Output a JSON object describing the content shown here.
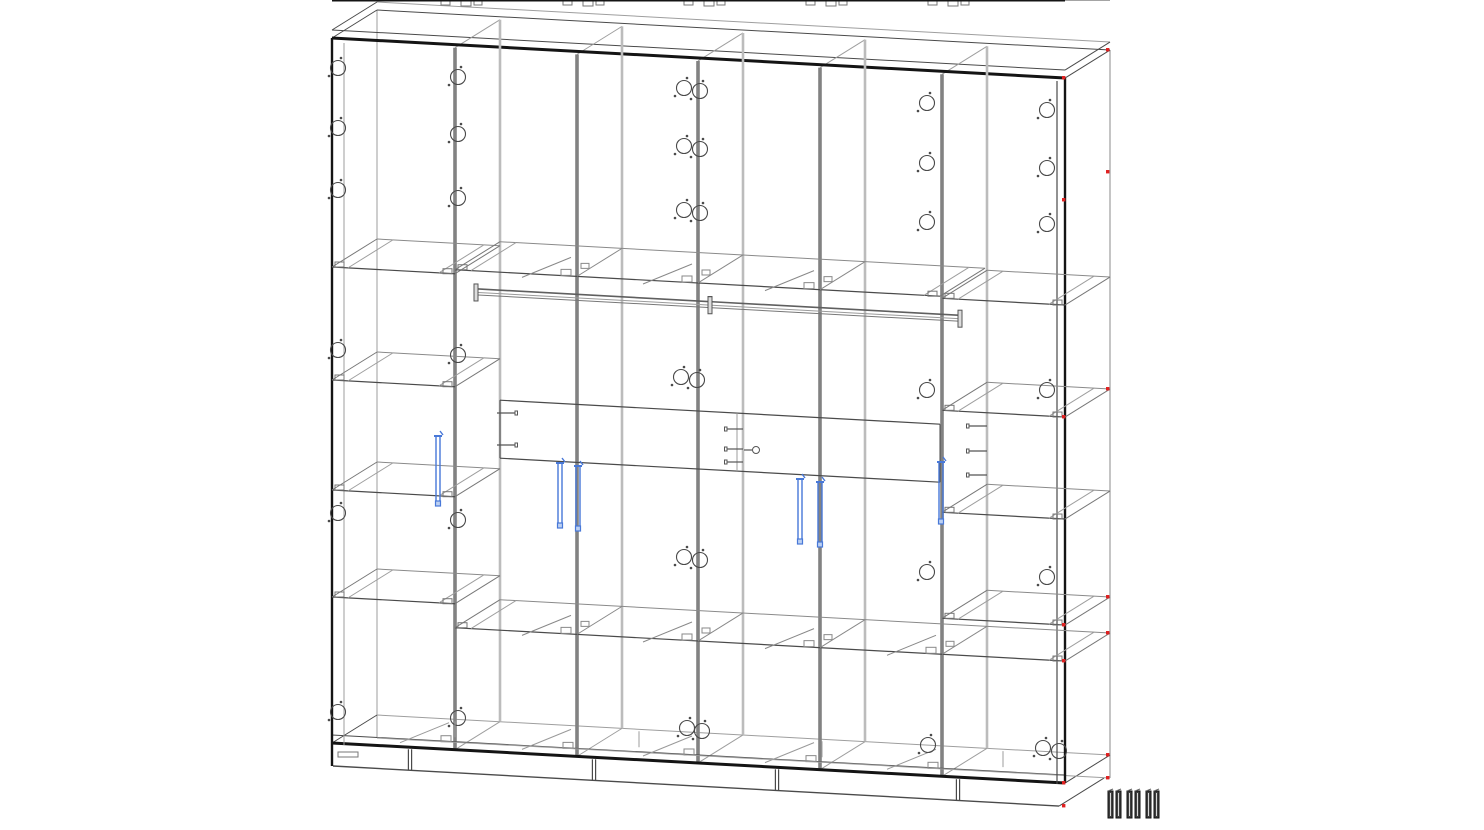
{
  "canvas": {
    "width": 1484,
    "height": 830,
    "background": "#ffffff"
  },
  "colors": {
    "outline": "#141414",
    "line": "#4a4a4a",
    "light": "#9e9e9e",
    "panel": "#828282",
    "panel_back": "#bcbcbc",
    "hardware": "#6f6f6f",
    "blue": "#4878d8",
    "red": "#e02020",
    "strip_fill": "#3f3f3f",
    "strip_inner": "#d8d8d8"
  },
  "view": {
    "x_left": 332,
    "x_right": 1065,
    "top_y": 38,
    "shear": 0.0546,
    "body_h": 705,
    "plinth_h": 23,
    "depth_dx": 45,
    "depth_dy": -28
  },
  "partitions": [
    455,
    577,
    698,
    820,
    942
  ],
  "mezzanine_h": 122,
  "shelves": [
    {
      "x1": 332,
      "x2": 455,
      "h": 229
    },
    {
      "x1": 332,
      "x2": 455,
      "h": 342
    },
    {
      "x1": 332,
      "x2": 455,
      "h": 452
    },
    {
      "x1": 332,
      "x2": 455,
      "h": 559
    },
    {
      "x1": 942,
      "x2": 1065,
      "h": 227
    },
    {
      "x1": 942,
      "x2": 1065,
      "h": 339
    },
    {
      "x1": 942,
      "x2": 1065,
      "h": 441
    },
    {
      "x1": 942,
      "x2": 1065,
      "h": 547
    },
    {
      "x1": 455,
      "x2": 940,
      "h": 225
    },
    {
      "x1": 455,
      "x2": 1065,
      "h": 583
    }
  ],
  "band": {
    "x1": 500,
    "x2": 940,
    "h_top": 353,
    "h_bottom": 411,
    "mid_x": 737
  },
  "rods": {
    "h": 243,
    "segments": [
      {
        "x1": 478,
        "x2": 708
      },
      {
        "x1": 712,
        "x2": 958
      }
    ]
  },
  "handles": [
    {
      "x": 438,
      "y1": 434,
      "y2": 506
    },
    {
      "x": 560,
      "y1": 461,
      "y2": 528
    },
    {
      "x": 578,
      "y1": 464,
      "y2": 531
    },
    {
      "x": 800,
      "y1": 477,
      "y2": 544
    },
    {
      "x": 820,
      "y1": 480,
      "y2": 547
    },
    {
      "x": 941,
      "y1": 460,
      "y2": 524
    }
  ],
  "holes": [
    [
      338,
      68
    ],
    [
      338,
      128
    ],
    [
      338,
      190
    ],
    [
      338,
      350
    ],
    [
      338,
      513
    ],
    [
      338,
      712
    ],
    [
      458,
      77
    ],
    [
      458,
      134
    ],
    [
      458,
      198
    ],
    [
      458,
      355
    ],
    [
      458,
      520
    ],
    [
      458,
      718
    ],
    [
      684,
      88
    ],
    [
      700,
      91
    ],
    [
      684,
      146
    ],
    [
      700,
      149
    ],
    [
      684,
      210
    ],
    [
      700,
      213
    ],
    [
      681,
      377
    ],
    [
      697,
      380
    ],
    [
      684,
      557
    ],
    [
      700,
      560
    ],
    [
      687,
      728
    ],
    [
      702,
      731
    ],
    [
      927,
      103
    ],
    [
      927,
      163
    ],
    [
      927,
      222
    ],
    [
      927,
      390
    ],
    [
      927,
      572
    ],
    [
      928,
      745
    ],
    [
      1047,
      110
    ],
    [
      1047,
      168
    ],
    [
      1047,
      224
    ],
    [
      1047,
      390
    ],
    [
      1047,
      577
    ],
    [
      1043,
      748
    ],
    [
      1059,
      751
    ]
  ],
  "pins": [
    {
      "x": 497,
      "y": 413,
      "len": 18
    },
    {
      "x": 497,
      "y": 445,
      "len": 18
    },
    {
      "x": 743,
      "y": 429,
      "len": -16
    },
    {
      "x": 743,
      "y": 449,
      "len": -16
    },
    {
      "x": 743,
      "y": 462,
      "len": -16
    },
    {
      "x": 987,
      "y": 426,
      "len": -18
    },
    {
      "x": 987,
      "y": 451,
      "len": -18
    },
    {
      "x": 987,
      "y": 475,
      "len": -18
    }
  ],
  "knobs": [
    {
      "x": 756,
      "y": 450
    }
  ],
  "red_marker_levels": [
    0,
    122,
    339,
    547,
    583,
    705,
    728
  ],
  "feet_x": [
    410,
    594,
    777,
    958
  ],
  "strips": {
    "xs": [
      1108,
      1116,
      1127,
      1135,
      1146,
      1154
    ],
    "y": 791,
    "w": 5,
    "h": 27
  }
}
